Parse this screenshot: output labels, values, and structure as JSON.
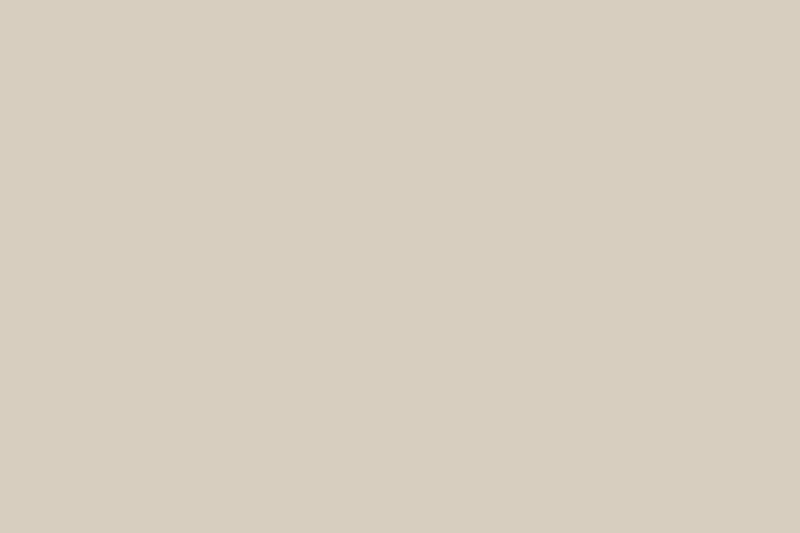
{
  "scene": {
    "description": "Photograph of an architectural scale model of a restaurant interior: white partition walls with pine caps form back-of-house rooms at the rear; a gray-floored dining area holds wooden tables with plates and slatted chairs behind a tall wooden batten screen; a white staircase, rattan basket chair, beige armchair and brown platform sofa sit mid-scene; the upper-right terrace has a white parasol, bistro set, slatted fence, round stone feature, koi pond with orange fish, stepping stones and orange flowers. The model rests on a light pine base over a dark wooden table, with a dried-flower bouquet on an olive museum counter at upper left and a dark vase of branches against the gray wall at upper right.",
    "objects": [
      "backdrop wall",
      "museum counter",
      "dried bouquet",
      "branch vase",
      "scale model",
      "partition maze",
      "kitchen counters",
      "dining tables",
      "slat screen",
      "staircase",
      "basket chair",
      "sofa",
      "terrace garden",
      "parasol",
      "koi pond",
      "stepping stones",
      "acrylic panel",
      "pine base table"
    ]
  },
  "palette": {
    "bg-left": "#7e7a6f",
    "bg-right": "#8f897d",
    "panel-olive": "#686b62",
    "panel-dark": "#4c5051",
    "vase": "#352a21",
    "branch": "#7a6753",
    "counter-front": "#746b53",
    "counter-top": "#c9b488",
    "parcel": "#e7e5df",
    "flowers": "#7c5224",
    "pine": "#dcc193",
    "wall-white": "#ebe5d9",
    "cap": "#dcc59e",
    "wall-shadow": "#b3aca0",
    "inner-dark": "#201f1c",
    "floor-gray": "#85858a",
    "paving": "#90908a",
    "front-wood": "#6f5741",
    "table-dark": "#46362a",
    "screen-wood": "#aa7d45",
    "screen-dark": "#6b4721",
    "set-wood": "#b4762f",
    "chair-wood": "#9a682e",
    "plate": "#f1ede3",
    "stairs": "#f1eee7",
    "stair-shadow": "#d8d3c7",
    "sofa": "#573f2d",
    "sofa-dark": "#452f20",
    "cushion": "#d7c3a3",
    "green": "#47602f",
    "green-dark": "#2f4420",
    "koi": "#e2772b",
    "pond": "#98988f",
    "stone": "#9a988f",
    "stone-floor": "#ebe7dc",
    "parasol": "#f4f1ea",
    "bistro": "#2b221a",
    "acrylic": "rgba(240,243,247,0.28)",
    "right-dark": "#21241e",
    "beige": "#d8cec0",
    "orange": "#e08236",
    "basket": "#c49a66",
    "cart": "#161210",
    "stool": "#e8d8b2"
  }
}
